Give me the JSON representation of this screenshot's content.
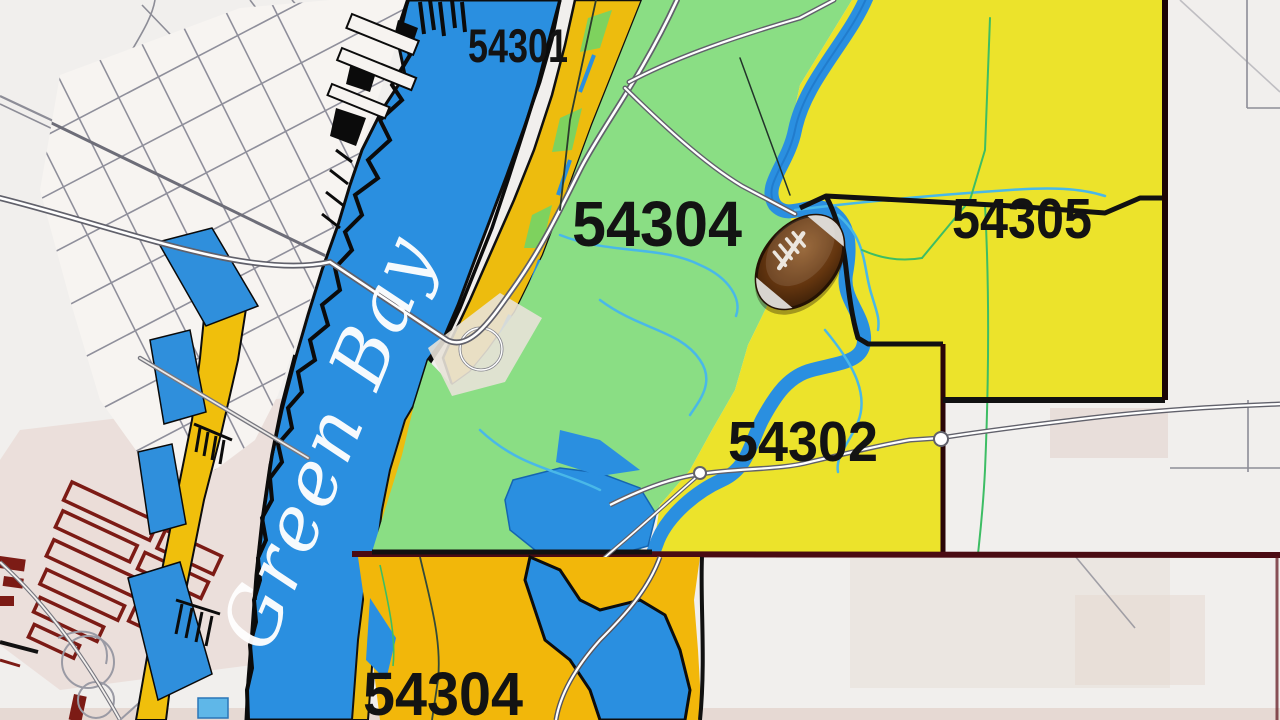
{
  "map": {
    "region_labels": [
      {
        "zip": "54301"
      },
      {
        "zip": "54304"
      },
      {
        "zip": "54305"
      },
      {
        "zip": "54302"
      },
      {
        "zip": "54304"
      }
    ],
    "water_label": "Green Bay",
    "marker": {
      "type": "football"
    },
    "colors": {
      "water": "#2a8fe0",
      "zone_green": "#8ade84",
      "zone_yellow": "#ece32b",
      "zone_gold": "#f0b70a",
      "boundary_black": "#111111",
      "boundary_maroon": "#4a0b12",
      "building_red": "#7c1b15",
      "background": "#f1efed"
    }
  }
}
